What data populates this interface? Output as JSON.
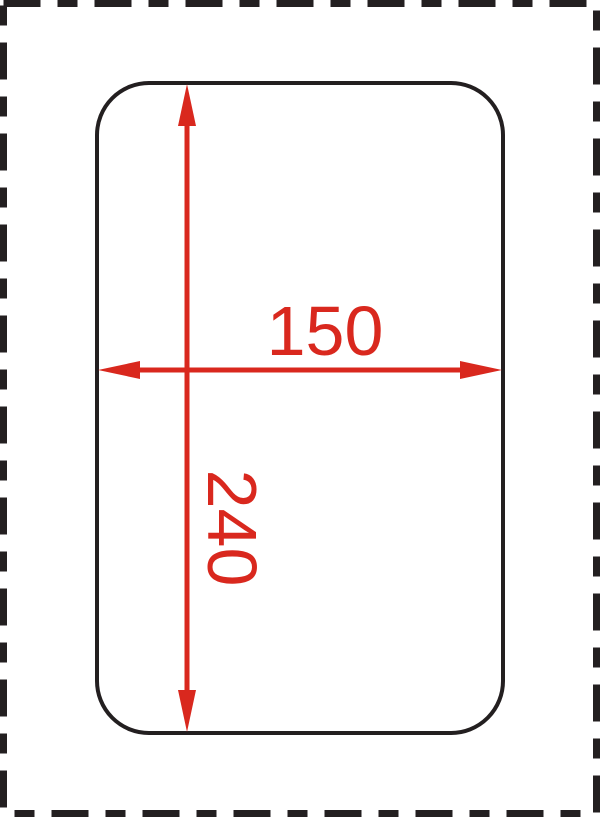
{
  "drawing": {
    "kind": "technical-dimension-diagram",
    "shape": "rounded-rectangle",
    "dimensions": {
      "width_label": "150",
      "height_label": "240"
    },
    "colors": {
      "outline": "#231f20",
      "border": "#231f20",
      "dimension": "#d9281e",
      "background": "#ffffff"
    }
  }
}
